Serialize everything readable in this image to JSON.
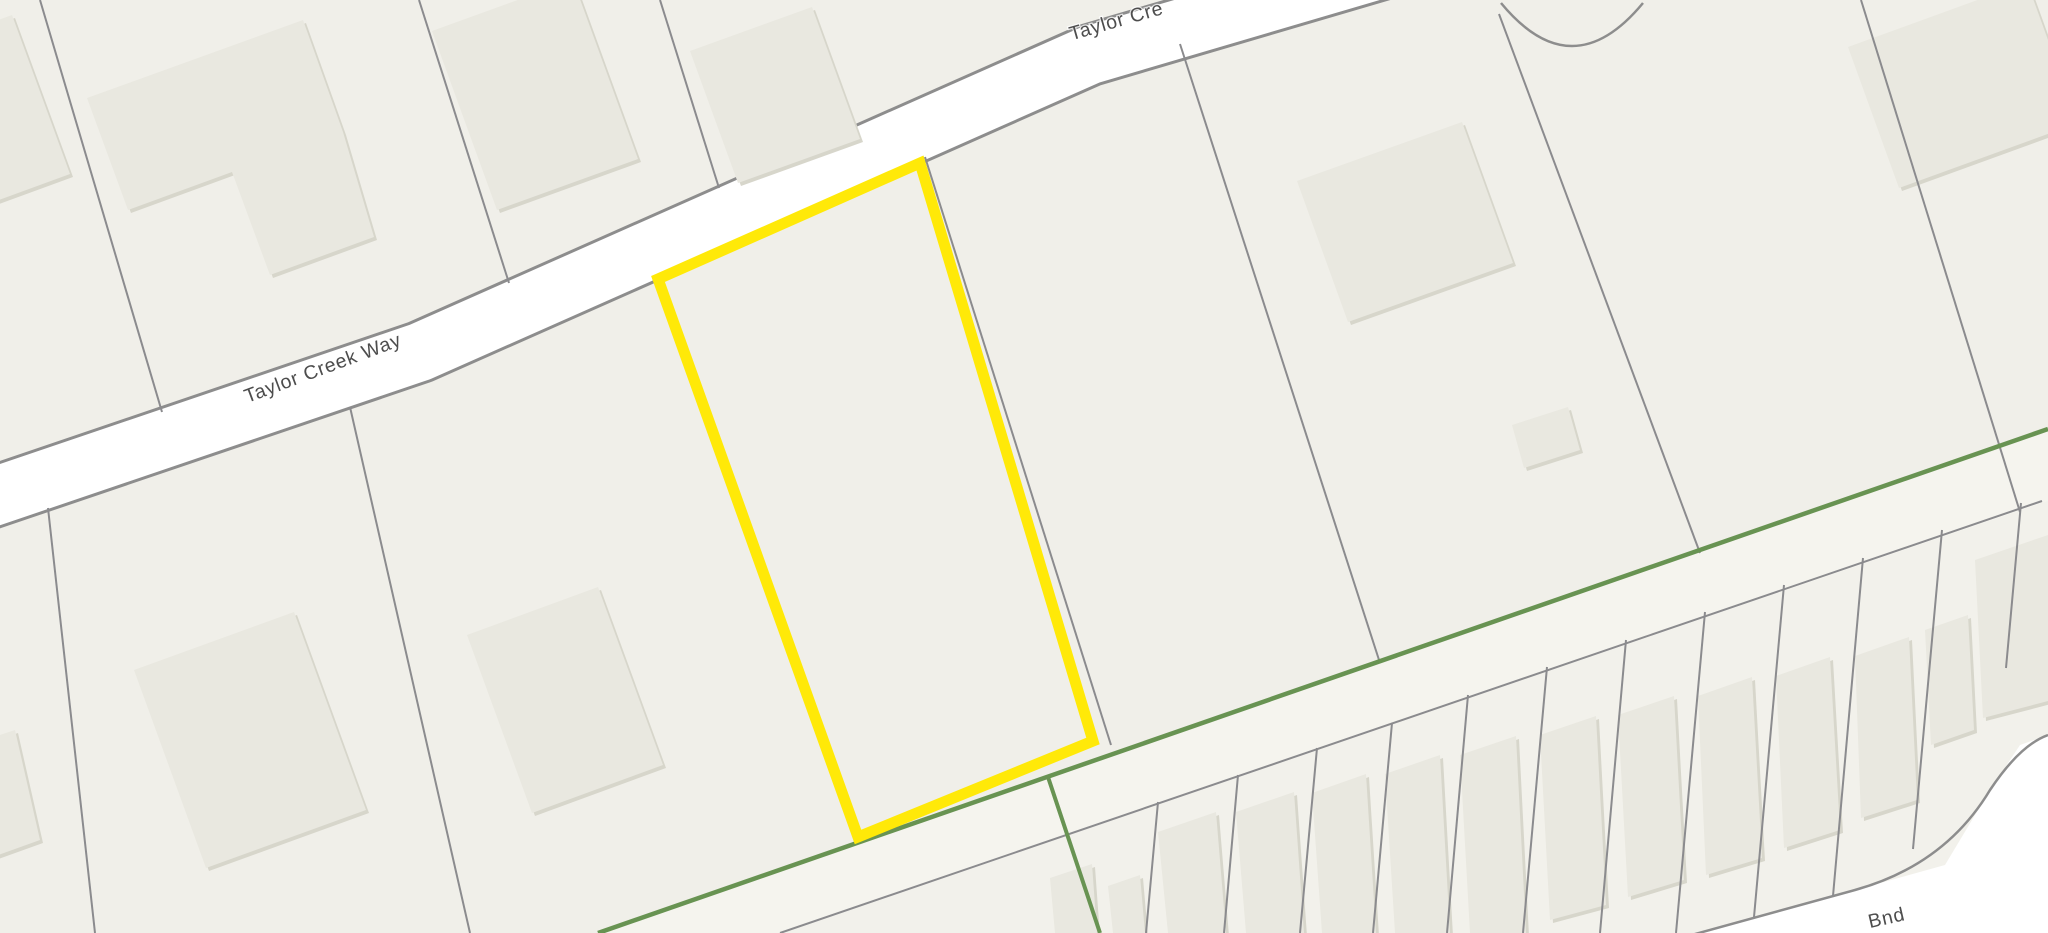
{
  "map": {
    "canvas": {
      "width": 2048,
      "height": 933,
      "background": "#f0efe9"
    },
    "palette": {
      "parcel_base": "#f0efe9",
      "below_boundary_tint": "#f2f1eb",
      "road2_corridor_tint": "#f5f4ee",
      "road_surface": "#ffffff",
      "road_casing": "#8d8d8d",
      "parcel_line": "#8b8b8e",
      "building_fill": "#e9e8e0",
      "building_shadow": "#d7d6cb",
      "boundary_green": "#689352",
      "highlight_yellow": "#ffe908",
      "label_color": "#4d4d4d"
    },
    "regions": [
      {
        "name": "region-below-green-boundary",
        "points": "598,933 2048,429 2048,933",
        "fill": "#f2f1eb"
      },
      {
        "name": "region-road2-corridor",
        "points": "598,933 2048,429 2048,501 780,933",
        "fill": "#f5f4ee"
      }
    ],
    "streets": {
      "taylor_creek_way": {
        "name": "road-taylor-creek-way",
        "path": "M -60,515 L 420,352 L 1090,55 L 1430,-45",
        "surface_width": 58,
        "casing_width": 64
      },
      "bnd_street": {
        "name": "road-bnd",
        "surface_points": "1688,936 1855,890 1945,865 1990,790 2020,745 2048,735 2048,933",
        "casing_path": "M 1688,936 L 1855,890 Q 1945,865 1990,790 Q 2020,745 2048,735",
        "casing_width": 2.5
      }
    },
    "culdesac": {
      "name": "cul-de-sac-curve",
      "d": "M 1501,3 Q 1572,89 1643,3",
      "width": 2.5
    },
    "parcel_lines": [
      {
        "name": "parcel-line",
        "d": "M 40,0 L 162,412"
      },
      {
        "name": "parcel-line",
        "d": "M 419,0 L 509,283"
      },
      {
        "name": "parcel-line",
        "d": "M 660,0 L 719,188"
      },
      {
        "name": "parcel-line",
        "d": "M 48,508 L 95,933"
      },
      {
        "name": "parcel-line",
        "d": "M 350,407 L 470,933"
      },
      {
        "name": "parcel-line",
        "d": "M 925,157 L 1111,745"
      },
      {
        "name": "parcel-line",
        "d": "M 1180,44 L 1380,663"
      },
      {
        "name": "parcel-line",
        "d": "M 1499,14 L 1700,553"
      },
      {
        "name": "parcel-line",
        "d": "M 1861,0 L 2020,512"
      },
      {
        "name": "parcel-line-lot-frontage",
        "d": "M 780,933 L 2042,501"
      },
      {
        "name": "parcel-line-lot",
        "d": "M 1158,802 L 1146,933"
      },
      {
        "name": "parcel-line-lot",
        "d": "M 1238,775 L 1224,933"
      },
      {
        "name": "parcel-line-lot",
        "d": "M 1317,748 L 1300,933"
      },
      {
        "name": "parcel-line-lot",
        "d": "M 1392,723 L 1373,933"
      },
      {
        "name": "parcel-line-lot",
        "d": "M 1468,695 L 1447,933"
      },
      {
        "name": "parcel-line-lot",
        "d": "M 1547,667 L 1523,933"
      },
      {
        "name": "parcel-line-lot",
        "d": "M 1626,640 L 1600,933"
      },
      {
        "name": "parcel-line-lot",
        "d": "M 1705,612 L 1676,933"
      },
      {
        "name": "parcel-line-lot",
        "d": "M 1784,585 L 1754,917"
      },
      {
        "name": "parcel-line-lot",
        "d": "M 1863,558 L 1833,896"
      },
      {
        "name": "parcel-line-lot",
        "d": "M 1942,530 L 1913,849"
      },
      {
        "name": "parcel-line-lot",
        "d": "M 2021,503 L 2006,668"
      }
    ],
    "buildings": [
      {
        "name": "building-house",
        "points": "12,15 70,174 -42,215 -100,56"
      },
      {
        "name": "building-house",
        "points": "303,20 343,132 374,237 270,275 232,172 128,210 87,98"
      },
      {
        "name": "building-house",
        "points": "573,-20 638,159 497,210 432,31"
      },
      {
        "name": "building-house",
        "points": "812,7 860,139 738,183 690,51"
      },
      {
        "name": "building-house",
        "points": "1462,122 1513,263 1348,322 1297,181"
      },
      {
        "name": "building-house",
        "points": "2027,-18 2078,123 1899,188 1848,47"
      },
      {
        "name": "building-shed",
        "points": "1512,425 1568,407 1580,450 1524,468"
      },
      {
        "name": "building-house",
        "points": "294,612 366,810 206,868 134,670"
      },
      {
        "name": "building-house",
        "points": "598,587 663,765 532,813 467,635"
      },
      {
        "name": "building-house",
        "points": "-30,745 15,730 40,840 -10,858"
      },
      {
        "name": "building-townhouse",
        "points": "1050,878 1092,864 1097,933 1055,933"
      },
      {
        "name": "building-townhouse",
        "points": "1108,886 1140,875 1145,933 1113,933"
      },
      {
        "name": "building-townhouse",
        "points": "1158,832 1216,812 1226,933 1168,933"
      },
      {
        "name": "building-townhouse",
        "points": "1236,812 1294,792 1304,933 1246,933"
      },
      {
        "name": "building-townhouse",
        "points": "1312,793 1366,774 1376,933 1322,933"
      },
      {
        "name": "building-townhouse",
        "points": "1385,774 1440,755 1450,933 1395,933"
      },
      {
        "name": "building-townhouse",
        "points": "1460,755 1516,736 1526,933 1470,933"
      },
      {
        "name": "building-townhouse",
        "points": "1540,735 1596,716 1606,905 1550,920"
      },
      {
        "name": "building-townhouse",
        "points": "1618,715 1674,696 1684,880 1628,897"
      },
      {
        "name": "building-townhouse",
        "points": "1698,696 1752,677 1762,858 1706,875"
      },
      {
        "name": "building-townhouse",
        "points": "1776,676 1830,657 1840,830 1784,848"
      },
      {
        "name": "building-townhouse",
        "points": "1855,656 1909,637 1917,800 1861,818"
      },
      {
        "name": "building-townhouse",
        "points": "1925,630 1968,615 1974,730 1931,745"
      },
      {
        "name": "building-townhouse",
        "points": "1975,560 2048,535 2052,700 1983,718"
      }
    ],
    "boundaries": [
      {
        "name": "green-boundary-main",
        "d": "M 598,933 L 2048,429",
        "width": 4.5
      },
      {
        "name": "green-boundary-branch",
        "d": "M 1048,777 L 1100,933",
        "width": 4
      }
    ],
    "selected_parcel": {
      "name": "selected-parcel-highlight",
      "points": "658,279 920,163 1093,741 858,837",
      "stroke_width": 11
    },
    "road_labels": [
      {
        "name": "road-label-taylor-creek-way",
        "text": "Taylor Creek Way",
        "x": 325,
        "y": 374,
        "rotation": -20.5,
        "size": 19.5
      },
      {
        "name": "road-label-taylor-creek-way-top",
        "text": "Taylor Cre",
        "x": 1118,
        "y": 27,
        "rotation": -16,
        "size": 19.5
      },
      {
        "name": "road-label-bnd",
        "text": "Bnd",
        "x": 1888,
        "y": 924,
        "rotation": -13,
        "size": 19.5
      }
    ]
  }
}
